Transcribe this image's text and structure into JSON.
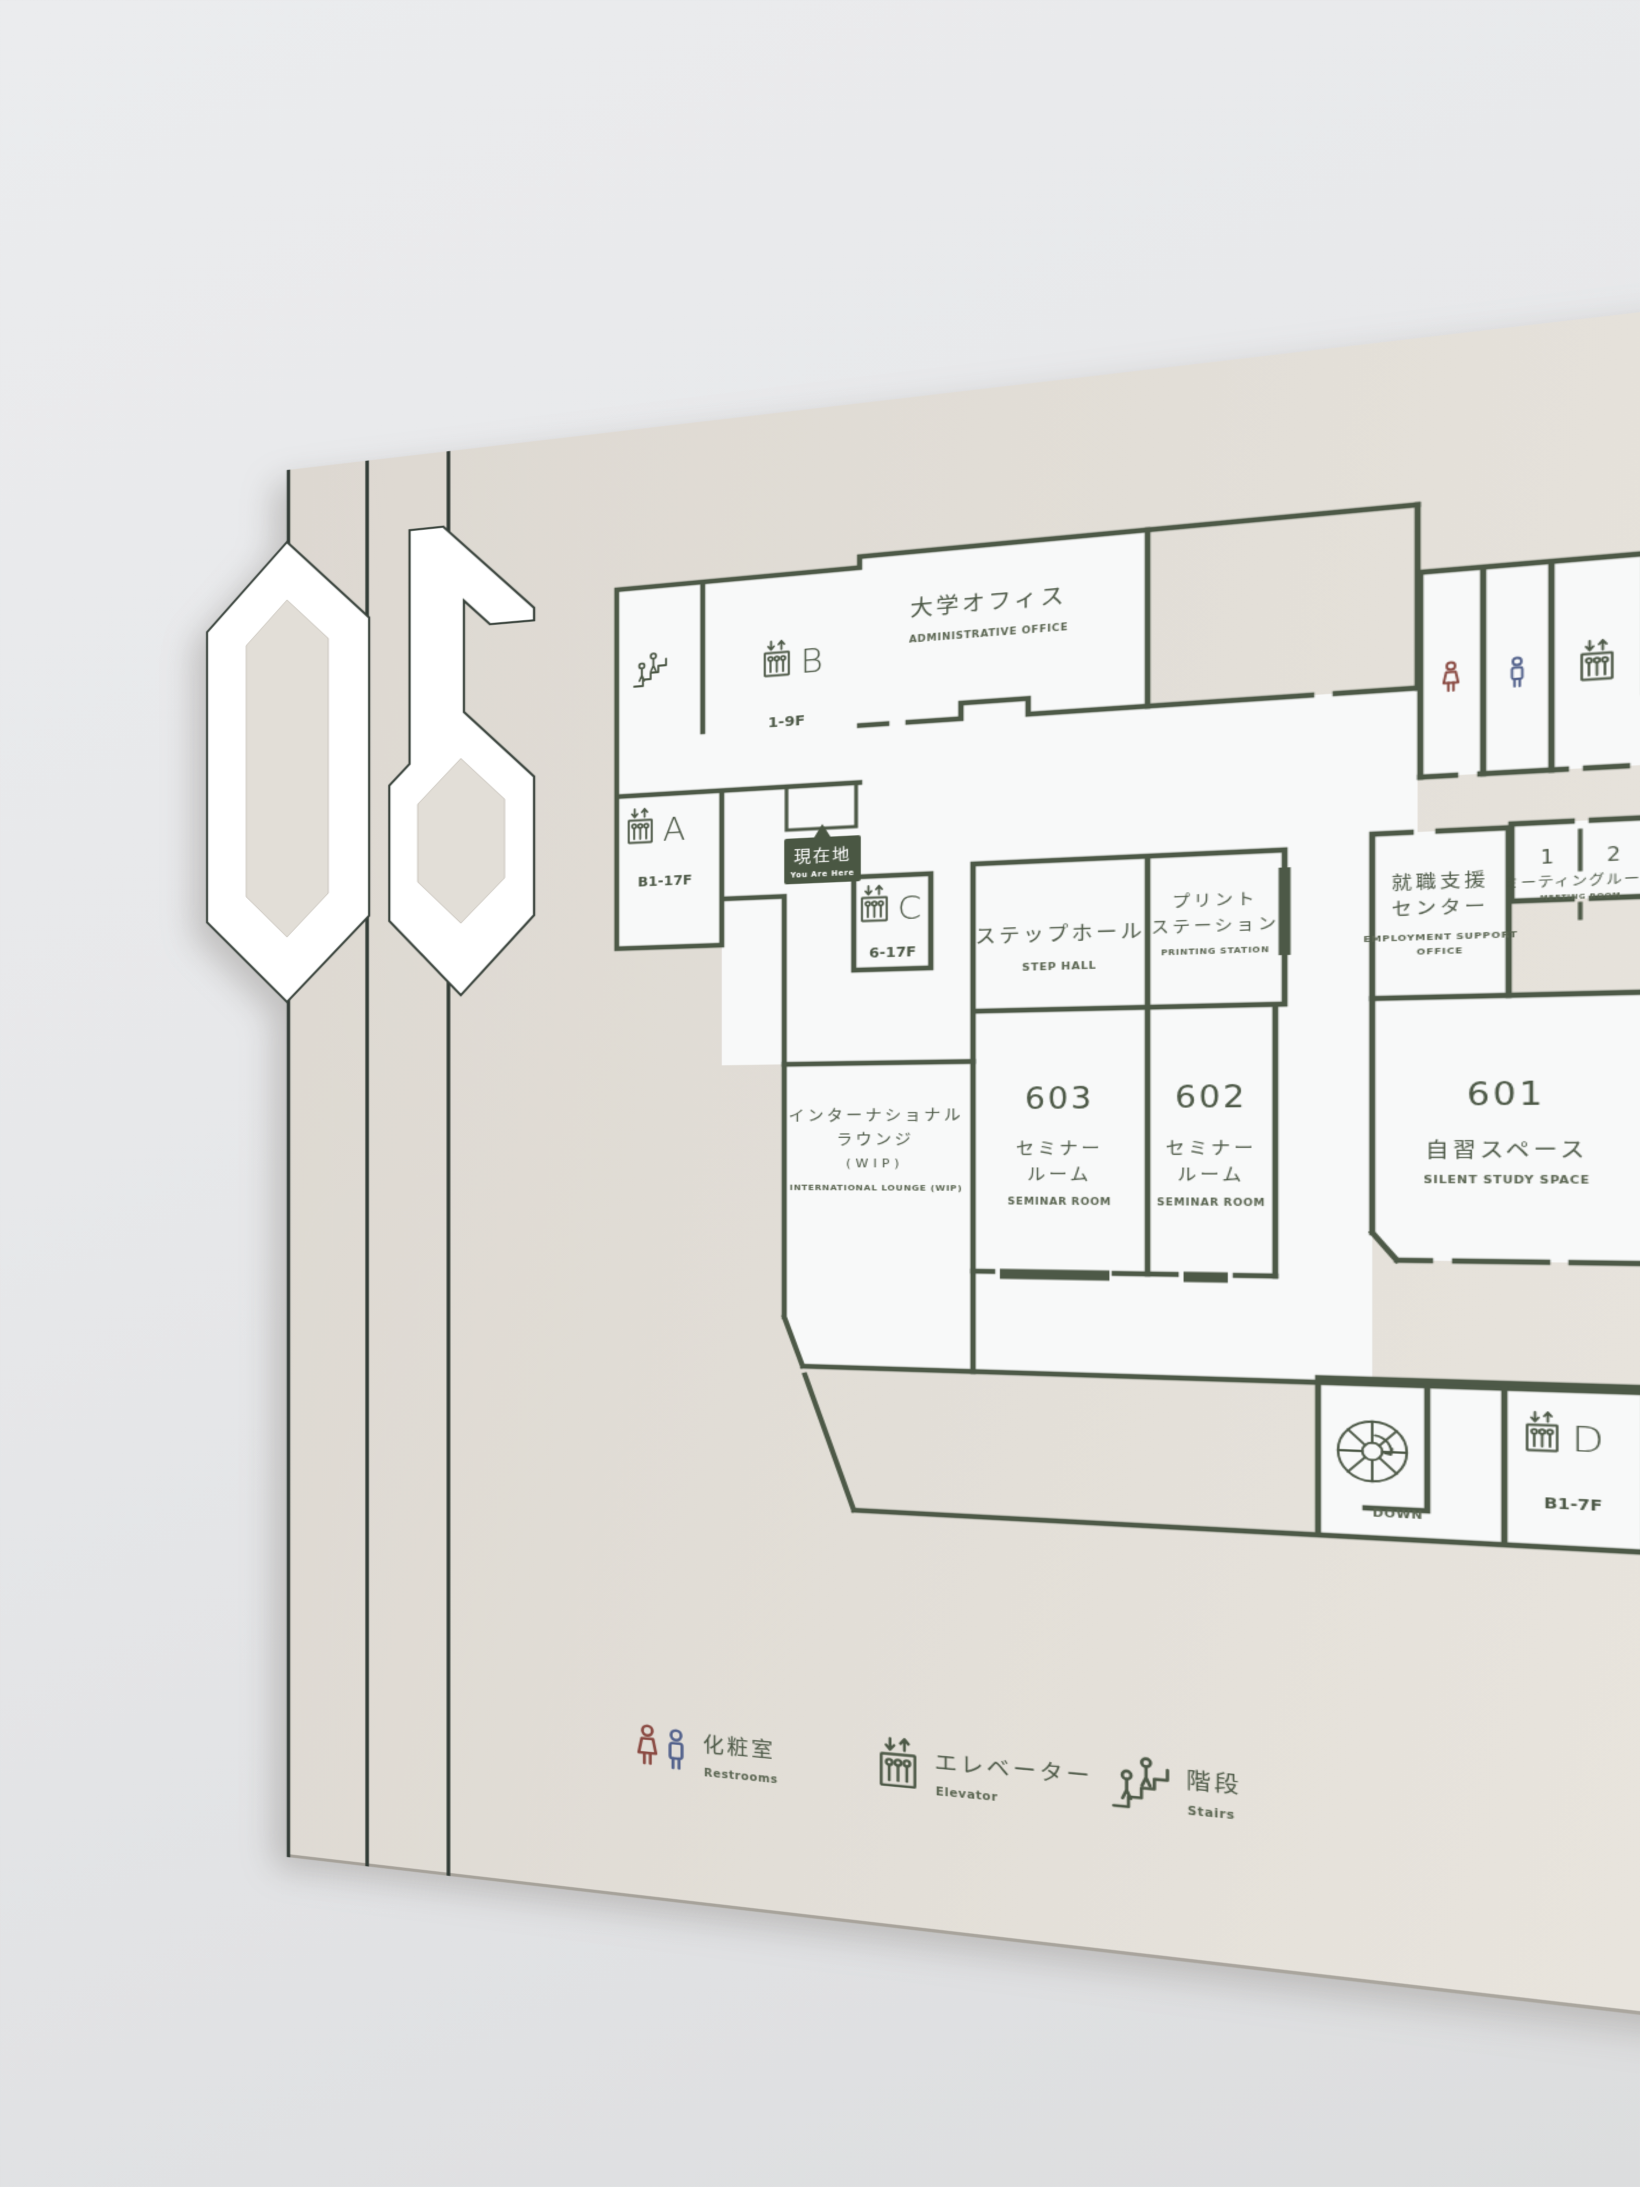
{
  "sign": {
    "floor": "06",
    "you_are_here": {
      "jp": "現在地",
      "en": "You Are Here"
    },
    "rooms": {
      "admin_office": {
        "jp": "大学オフィス",
        "en": "ADMINISTRATIVE OFFICE"
      },
      "step_hall": {
        "jp": "ステップホール",
        "en": "STEP HALL"
      },
      "printing_station": {
        "jp1": "プリント",
        "jp2": "ステーション",
        "en": "PRINTING STATION"
      },
      "employment": {
        "jp1": "就職支援",
        "jp2": "センター",
        "en1": "EMPLOYMENT SUPPORT",
        "en2": "OFFICE"
      },
      "meeting": {
        "no1": "1",
        "no2": "2",
        "jp": "ミーティングルーム",
        "en": "MEETING ROOM"
      },
      "lounge": {
        "jp1": "インターナショナル",
        "jp2": "ラウンジ",
        "jp3": "(WIP)",
        "en": "INTERNATIONAL LOUNGE (WIP)"
      },
      "seminar603": {
        "number": "603",
        "jp1": "セミナー",
        "jp2": "ルーム",
        "en": "SEMINAR ROOM"
      },
      "seminar602": {
        "number": "602",
        "jp1": "セミナー",
        "jp2": "ルーム",
        "en": "SEMINAR ROOM"
      },
      "study601": {
        "number": "601",
        "jp": "自習スペース",
        "en": "SILENT STUDY SPACE"
      }
    },
    "elevators": {
      "a": {
        "letter": "A",
        "floors": "B1-17F"
      },
      "b": {
        "letter": "B",
        "floors": "1-9F"
      },
      "c": {
        "letter": "C",
        "floors": "6-17F"
      },
      "d": {
        "letter": "D",
        "floors": "B1-7F"
      }
    },
    "stair_down_label": "DOWN",
    "legend": {
      "restrooms": {
        "jp": "化粧室",
        "en": "Restrooms"
      },
      "elevator": {
        "jp": "エレベーター",
        "en": "Elevator"
      },
      "stairs": {
        "jp": "階段",
        "en": "Stairs"
      }
    },
    "colors": {
      "wall_line": "#4d5947",
      "badge_bg": "#4a5743",
      "female_icon": "#8a4a42",
      "male_icon": "#53628c",
      "panel": "#e0dcd5"
    }
  }
}
